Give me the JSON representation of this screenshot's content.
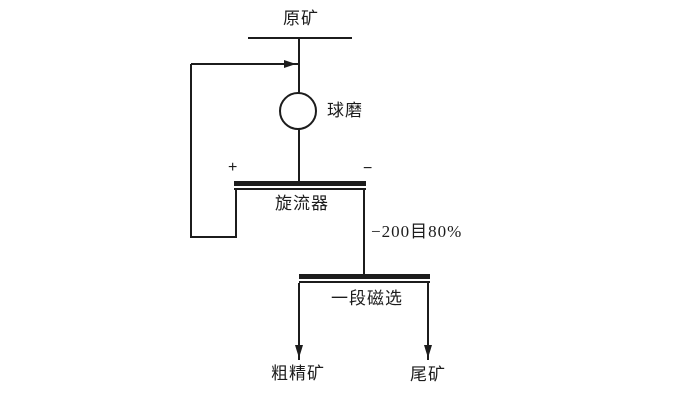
{
  "labels": {
    "raw_ore": "原矿",
    "ball_mill": "球磨",
    "cyclone_plus": "+",
    "cyclone_minus": "−",
    "cyclone": "旋流器",
    "overflow_fineness": "−200目80%",
    "magnetic_separation": "一段磁选",
    "rough_concentrate": "粗精矿",
    "tailings": "尾矿"
  },
  "connections": [
    "raw-ore feeds ball-mill",
    "ball-mill discharges to cyclone",
    "cyclone underflow (+) recirculates to ball-mill feed",
    "cyclone overflow (−) at −200目80% feeds one-stage magnetic separation",
    "magnetic separation yields rough-concentrate and tailings"
  ],
  "colors": {
    "line": "#1c1c1c",
    "background": "#ffffff"
  }
}
